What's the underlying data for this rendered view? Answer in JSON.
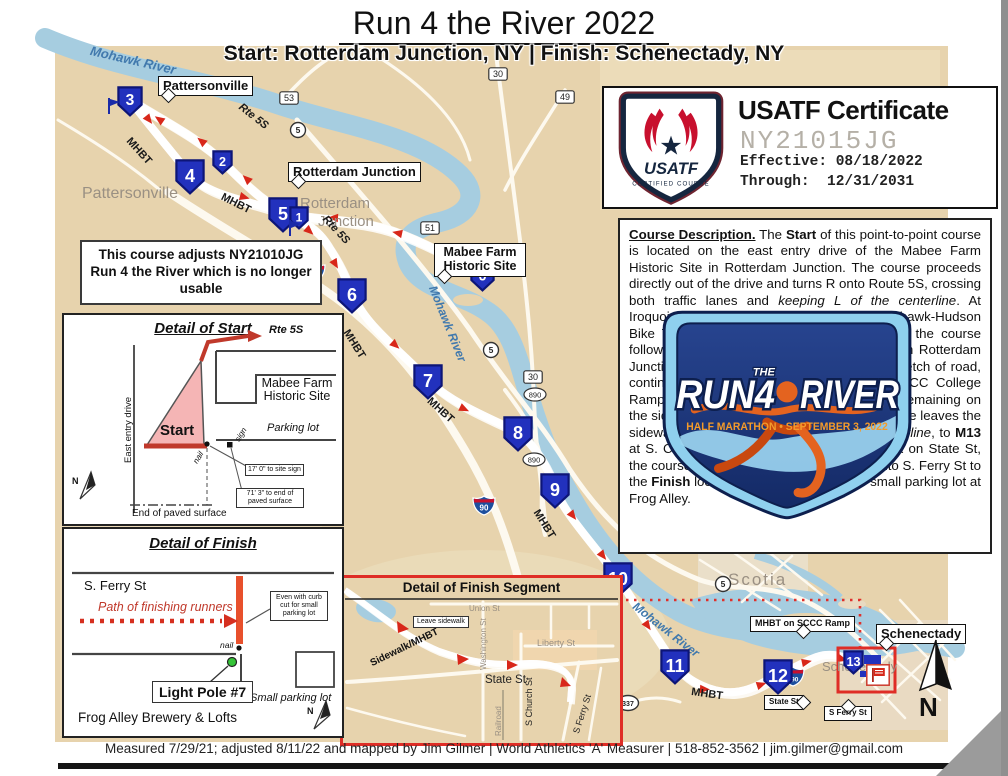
{
  "page": {
    "title": "Run 4 the River 2022",
    "subtitle": "Start: Rotterdam Junction, NY | Finish: Schenectady, NY",
    "footer": "Measured 7/29/21; adjusted 8/11/22 and mapped by Jim Gilmer | World Athletics 'A' Measurer | 518-852-3562 | jim.gilmer@gmail.com",
    "north": "N"
  },
  "certificate": {
    "badge_name": "USATF",
    "badge_sub": "CERTIFIED COURSE",
    "title": "USATF Certificate",
    "number": "NY21015JG",
    "effective_label": "Effective:",
    "effective_value": "08/18/2022",
    "through_label": "Through:",
    "through_value": "12/31/2031"
  },
  "note_box": "This course adjusts NY21010JG Run 4 the River which is no longer usable",
  "logo": {
    "word1": "RUN4",
    "the": "THE",
    "word2": "RIVER",
    "tagline": "HALF MARATHON • SEPTEMBER 3, 2022"
  },
  "description": {
    "segments": [
      {
        "t": "Course Description.",
        "b": 1,
        "u": 1
      },
      {
        "t": " The "
      },
      {
        "t": "Start",
        "b": 1
      },
      {
        "t": " of this point-to-point course is located on the east entry drive of the Mabee Farm Historic Site in Rotterdam Junction. The course proceeds directly out of the drive and turns R onto Route 5S, crossing both traffic lanes and "
      },
      {
        "t": "keeping L of the centerline",
        "i": 1
      },
      {
        "t": ". At Iroquois St the course turns L onto the Mohawk-Hudson Bike Trail (MHBT) and, after the turnaround, the course follows the MHBT alongside Route 5S through Rotterdam Junction. At Rynex Creek it crosses a brief stretch of road, continuing on the MHBT to "
      },
      {
        "t": "M12",
        "b": 1
      },
      {
        "t": ". At the SCCC College Ramp the course turns L onto the sidewalk, remaining on the sidewalk to Washington St, where the course leaves the sidewalk onto State St, "
      },
      {
        "t": "keeping L of the centerline",
        "i": 1
      },
      {
        "t": ", to "
      },
      {
        "t": "M13",
        "b": 1
      },
      {
        "t": " at S. Church St. Continuing for another block on State St, the course turns R across all traffic lanes onto S. Ferry St to the "
      },
      {
        "t": "Finish",
        "b": 1
      },
      {
        "t": " located at the curb cut for the small parking lot at Frog Alley."
      }
    ]
  },
  "map": {
    "labels": [
      {
        "text": "Pattersonville",
        "x": 82,
        "y": 186,
        "fs": 16,
        "color": "#9a9083"
      },
      {
        "text": "Rotterdam",
        "x": 300,
        "y": 196,
        "fs": 15,
        "color": "#9a9083"
      },
      {
        "text": "Junction",
        "x": 318,
        "y": 214,
        "fs": 15,
        "color": "#9a9083"
      },
      {
        "text": "Scotia",
        "x": 728,
        "y": 571,
        "fs": 17,
        "color": "#9a9083",
        "ls": 2
      },
      {
        "text": "Schenectady",
        "x": 822,
        "y": 660,
        "fs": 13,
        "color": "#9a9083"
      },
      {
        "text": "Mohawk River",
        "x": 92,
        "y": 44,
        "fs": 13,
        "color": "#4179ad",
        "i": 1,
        "b": 1,
        "rot": 13
      },
      {
        "text": "Mohawk River",
        "x": 438,
        "y": 284,
        "fs": 12,
        "color": "#4179ad",
        "i": 1,
        "b": 1,
        "rot": 68
      },
      {
        "text": "Mohawk River",
        "x": 638,
        "y": 600,
        "fs": 12,
        "color": "#4179ad",
        "i": 1,
        "b": 1,
        "rot": 38
      },
      {
        "text": "MHBT",
        "x": 132,
        "y": 136,
        "fs": 11,
        "b": 1,
        "rot": 48
      },
      {
        "text": "MHBT",
        "x": 224,
        "y": 192,
        "fs": 11,
        "b": 1,
        "rot": 27
      },
      {
        "text": "MHBT",
        "x": 350,
        "y": 328,
        "fs": 11,
        "b": 1,
        "rot": 58
      },
      {
        "text": "MHBT",
        "x": 432,
        "y": 396,
        "fs": 11,
        "b": 1,
        "rot": 42
      },
      {
        "text": "MHBT",
        "x": 540,
        "y": 508,
        "fs": 11,
        "b": 1,
        "rot": 58
      },
      {
        "text": "MHBT",
        "x": 692,
        "y": 687,
        "fs": 11,
        "b": 1,
        "rot": 8
      },
      {
        "text": "Rte 5S",
        "x": 243,
        "y": 102,
        "fs": 11,
        "b": 1,
        "i": 1,
        "rot": 38
      },
      {
        "text": "Rte 5S",
        "x": 328,
        "y": 214,
        "fs": 11,
        "b": 1,
        "i": 1,
        "rot": 47
      }
    ],
    "callouts": [
      {
        "text": "Pattersonville",
        "x": 158,
        "y": 76,
        "fs": 13,
        "ptr": "bl"
      },
      {
        "text": "Rotterdam Junction",
        "x": 288,
        "y": 162,
        "fs": 13,
        "ptr": "bl"
      },
      {
        "text": "Mabee Farm Historic Site",
        "x": 434,
        "y": 243,
        "fs": 12.5,
        "w": 82,
        "ptr": "bl"
      },
      {
        "text": "Schenectady",
        "x": 876,
        "y": 624,
        "fs": 13,
        "ptr": "bl"
      },
      {
        "text": "MHBT on SCCC Ramp",
        "x": 750,
        "y": 616,
        "fs": 9,
        "ptr": "b"
      },
      {
        "text": "State St",
        "x": 764,
        "y": 695,
        "fs": 8,
        "ptr": "r"
      },
      {
        "text": "S Ferry St",
        "x": 824,
        "y": 706,
        "fs": 8,
        "ptr": "t"
      }
    ],
    "mile_markers": [
      {
        "n": "3",
        "x": 117,
        "y": 86,
        "s": 26
      },
      {
        "n": "2",
        "x": 212,
        "y": 150,
        "s": 21
      },
      {
        "n": "4",
        "x": 175,
        "y": 159,
        "s": 30
      },
      {
        "n": "5",
        "x": 268,
        "y": 197,
        "s": 30
      },
      {
        "n": "1",
        "x": 289,
        "y": 206,
        "s": 20
      },
      {
        "n": "0",
        "x": 470,
        "y": 262,
        "s": 25
      },
      {
        "n": "6",
        "x": 337,
        "y": 278,
        "s": 30
      },
      {
        "n": "7",
        "x": 413,
        "y": 364,
        "s": 30
      },
      {
        "n": "8",
        "x": 503,
        "y": 416,
        "s": 30
      },
      {
        "n": "9",
        "x": 540,
        "y": 473,
        "s": 30
      },
      {
        "n": "10",
        "x": 603,
        "y": 562,
        "s": 30
      },
      {
        "n": "11",
        "x": 660,
        "y": 649,
        "s": 30
      },
      {
        "n": "12",
        "x": 763,
        "y": 659,
        "s": 30
      },
      {
        "n": "13",
        "x": 843,
        "y": 650,
        "s": 21
      },
      {
        "n": "13",
        "x": 512,
        "y": 645,
        "s": 22
      }
    ],
    "flags": [
      {
        "kind": "blue",
        "x": 106,
        "y": 97
      },
      {
        "kind": "blue",
        "x": 287,
        "y": 219
      },
      {
        "kind": "red",
        "x": 866,
        "y": 664
      },
      {
        "kind": "red",
        "x": 550,
        "y": 680
      }
    ],
    "shields": [
      {
        "k": "i",
        "t": "90",
        "x": 302,
        "y": 262
      },
      {
        "k": "i",
        "t": "90",
        "x": 472,
        "y": 495
      },
      {
        "k": "i",
        "t": "890",
        "x": 781,
        "y": 666
      },
      {
        "k": "c",
        "t": "5",
        "x": 289,
        "y": 121
      },
      {
        "k": "c",
        "t": "5",
        "x": 482,
        "y": 341
      },
      {
        "k": "c",
        "t": "5",
        "x": 714,
        "y": 575
      },
      {
        "k": "c",
        "t": "337",
        "x": 616,
        "y": 694
      },
      {
        "k": "b",
        "t": "53",
        "x": 279,
        "y": 91
      },
      {
        "k": "b",
        "t": "30",
        "x": 488,
        "y": 67
      },
      {
        "k": "b",
        "t": "49",
        "x": 555,
        "y": 90
      },
      {
        "k": "b",
        "t": "51",
        "x": 420,
        "y": 221
      },
      {
        "k": "b",
        "t": "30",
        "x": 523,
        "y": 370
      },
      {
        "k": "o",
        "t": "890",
        "x": 523,
        "y": 387
      },
      {
        "k": "o",
        "t": "890",
        "x": 522,
        "y": 452
      }
    ]
  },
  "detail_start": {
    "title": "Detail of Start",
    "rte": "Rte 5S",
    "drive": "East entry drive",
    "start": "Start",
    "building": "Mabee Farm Historic Site",
    "parking": "Parking lot",
    "nail": "nail",
    "sign": "sign",
    "callout_sign": "17' 0\" to site sign",
    "callout_paved": "71' 3\" to end of paved surface",
    "paved": "End of paved surface",
    "north": "N"
  },
  "detail_finish": {
    "title": "Detail of Finish",
    "street": "S. Ferry St",
    "path": "Path of finishing runners",
    "callout": "Even with curb cut for small parking lot",
    "nail": "nail",
    "pole": "Light Pole #7",
    "parking": "Small parking lot",
    "brewery": "Frog Alley Brewery & Lofts",
    "north": "N"
  },
  "detail_segment": {
    "title": "Detail of Finish Segment",
    "union": "Union St",
    "washington": "Washington St",
    "liberty": "Liberty St",
    "state": "State St",
    "church": "S Church St",
    "railroad": "Railroad",
    "ferry": "S Ferry St",
    "sidewalk": "Sidewalk/MHBT",
    "leave": "Leave sidewalk",
    "mile": "13"
  }
}
